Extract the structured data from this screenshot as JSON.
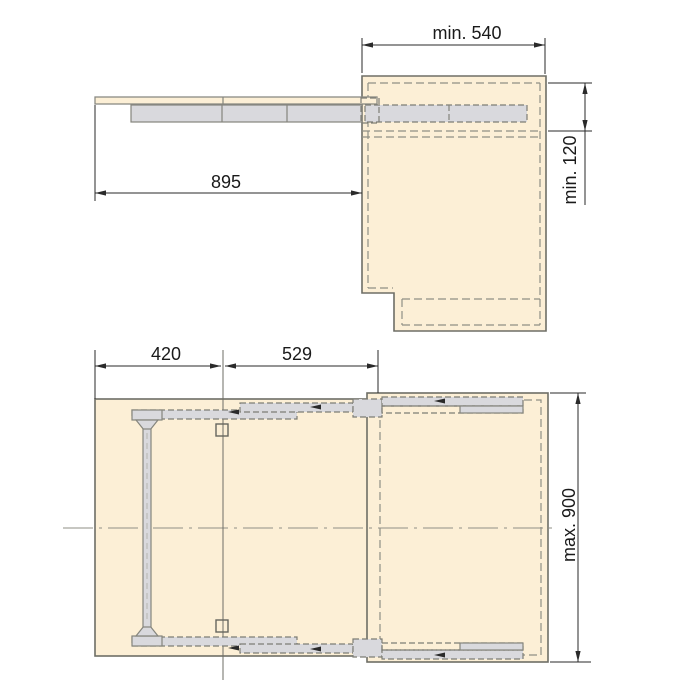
{
  "document": {
    "type": "technical-drawing",
    "subject": "Pull-out table mechanism installation drawing with side view and plan view"
  },
  "colors": {
    "background": "#ffffff",
    "panel_fill": "#fcefd6",
    "panel_outline": "#6e6e66",
    "hidden_line": "#8f8f85",
    "rail_fill": "#d9d9dd",
    "rail_outline": "#85857d",
    "dimension_line": "#2a2a2a",
    "text": "#1a1a1a"
  },
  "side_view": {
    "dimensions": {
      "cabinet_depth": "min. 540",
      "top_clearance": "min. 120",
      "pullout_extension": "895"
    }
  },
  "plan_view": {
    "dimensions": {
      "leg_offset": "420",
      "slide_length": "529",
      "max_extension": "max. 900"
    }
  }
}
